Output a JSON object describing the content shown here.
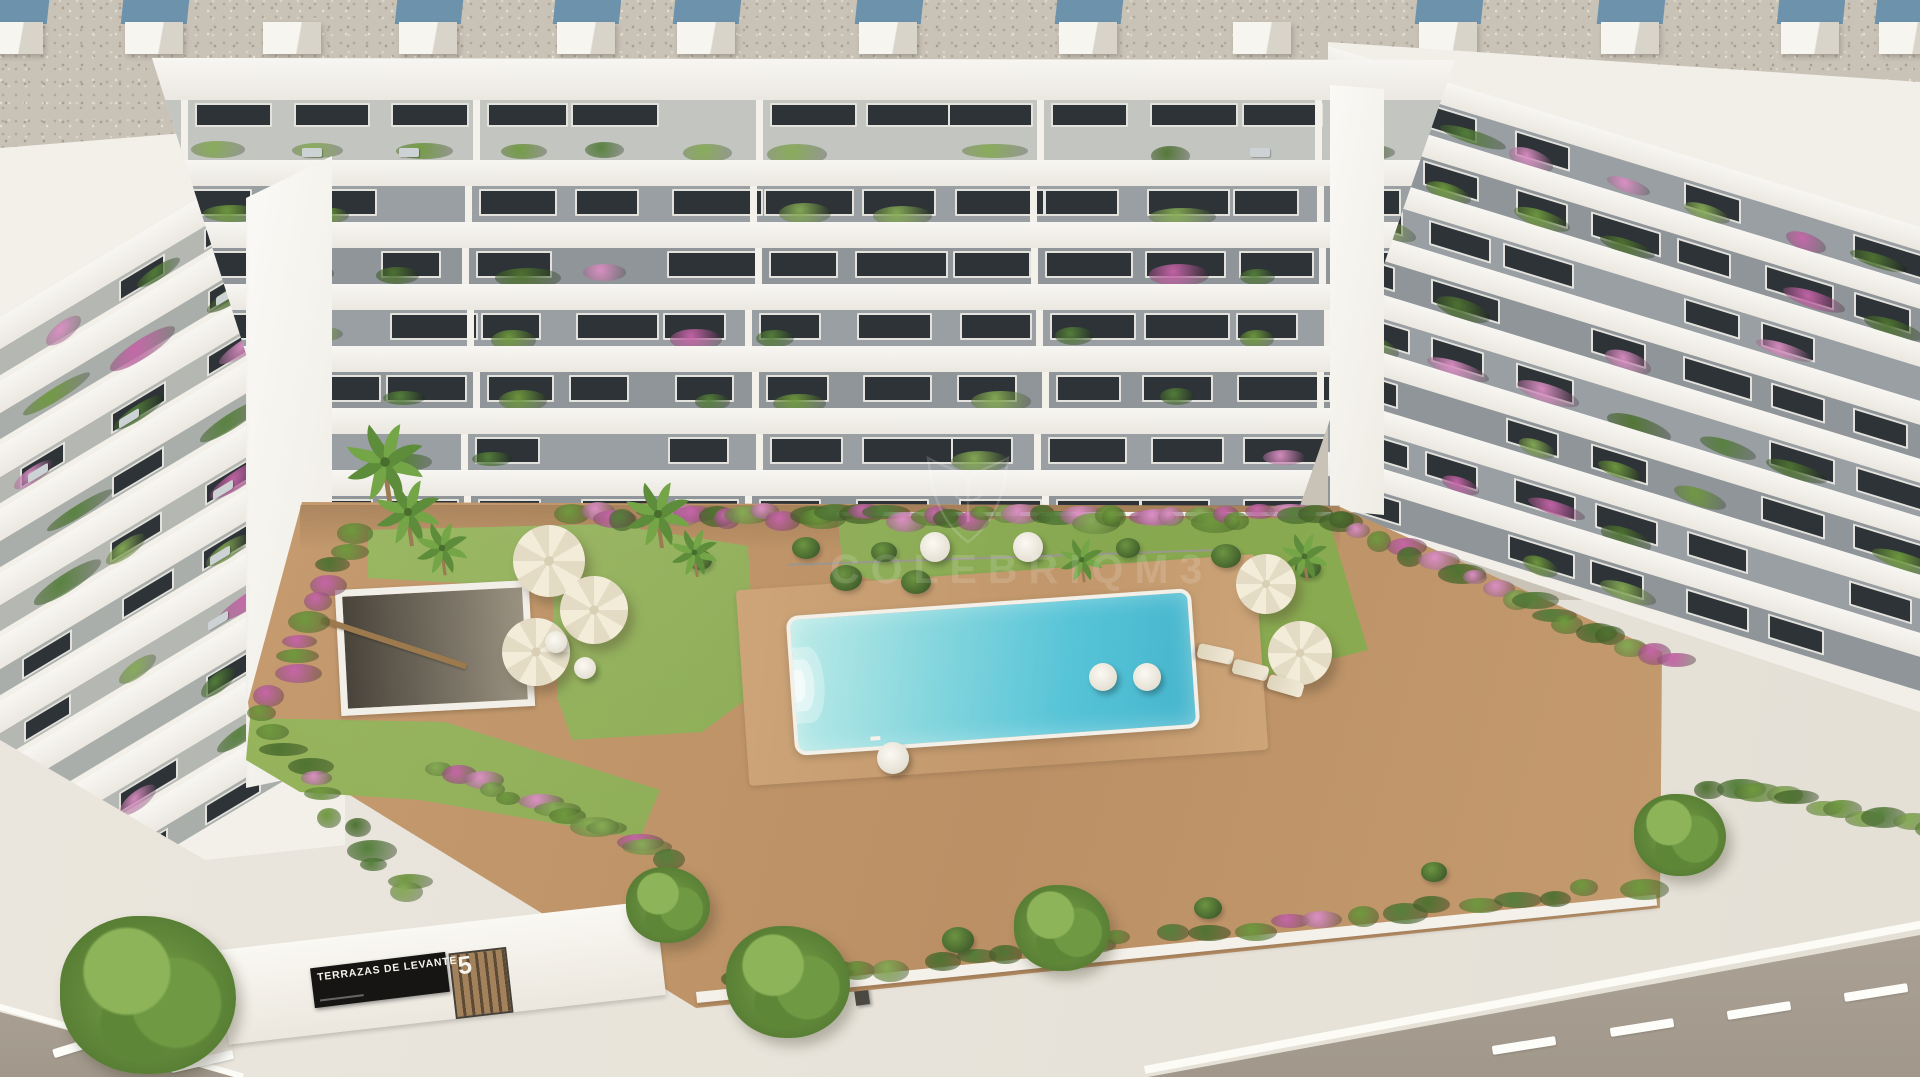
{
  "image_type": "3d-aerial-render",
  "subject": "white residential apartment complex with communal pool, lawns and gardens",
  "sign": {
    "title": "TERRAZAS DE LEVANTE",
    "block_number": "5"
  },
  "watermark": {
    "emblem": "crest-outline-icon",
    "text": "COLEBRIQM3",
    "opacity": 0.14
  },
  "palette": {
    "gravel": "#c9c2b6",
    "vent_blue": "#6d92ac",
    "building_white": "#f5f3ee",
    "facade_gray_a": "#999fa2",
    "facade_gray_b": "#8f9598",
    "penthouse_gray": "#c3c5c0",
    "left_terrace_gray": "#b4b7b2",
    "window_dark": "#2d3337",
    "path_tan": "#c49a6c",
    "lawn_green": "#8fae52",
    "pool_light": "#bdebe8",
    "pool_deep": "#45b5cd",
    "road": "#a69d90",
    "sidewalk": "#e8e4db",
    "flower_pink": "#c765a9",
    "flower_pink_light": "#dc8fc4",
    "foliage": [
      "#6f9a3e",
      "#55803a",
      "#86ab55",
      "#4f7431"
    ],
    "wood": "#9c7a4e",
    "sign_black": "#161513"
  },
  "scene": {
    "roof_vents": {
      "xs": [
        -18,
        122,
        260,
        396,
        554,
        674,
        856,
        1056,
        1230,
        1416,
        1598,
        1778,
        1876
      ],
      "white_only_idx": [
        2,
        8
      ]
    },
    "building": {
      "central_floors": 7,
      "left_wing_rows": 10,
      "right_wing_rows": 8
    },
    "pool": {
      "x": 790,
      "y": 602,
      "w": 398,
      "h": 132,
      "rotate_deg": -4,
      "steps": "left-end"
    },
    "objects": {
      "palms": [
        [
          385,
          462,
          1.2
        ],
        [
          408,
          512,
          1.0
        ],
        [
          442,
          548,
          0.8
        ],
        [
          658,
          514,
          1.0
        ],
        [
          694,
          552,
          0.72
        ],
        [
          1082,
          560,
          0.66
        ],
        [
          1304,
          556,
          0.72
        ]
      ],
      "trees": [
        [
          148,
          995,
          88
        ],
        [
          788,
          982,
          62
        ],
        [
          1062,
          928,
          48
        ],
        [
          1680,
          835,
          46
        ],
        [
          668,
          905,
          42
        ]
      ],
      "umbrellas": [
        [
          549,
          561,
          36
        ],
        [
          594,
          610,
          34
        ],
        [
          536,
          652,
          34
        ],
        [
          1266,
          584,
          30
        ],
        [
          1300,
          653,
          32
        ]
      ],
      "day_beds": [
        [
          935,
          547,
          15
        ],
        [
          1028,
          547,
          15
        ],
        [
          1103,
          677,
          14
        ],
        [
          1147,
          677,
          14
        ],
        [
          893,
          758,
          16
        ],
        [
          556,
          642,
          11
        ],
        [
          585,
          668,
          11
        ]
      ],
      "sun_loungers": [
        [
          1208,
          636,
          102
        ],
        [
          1243,
          652,
          104
        ],
        [
          1278,
          668,
          106
        ]
      ],
      "bushes": [
        [
          806,
          548,
          14
        ],
        [
          846,
          578,
          16
        ],
        [
          884,
          552,
          13
        ],
        [
          916,
          582,
          15
        ],
        [
          1128,
          548,
          12
        ],
        [
          1226,
          556,
          15
        ],
        [
          1266,
          590,
          17
        ],
        [
          1308,
          568,
          13
        ],
        [
          958,
          940,
          16
        ],
        [
          1208,
          908,
          14
        ],
        [
          1434,
          872,
          13
        ],
        [
          700,
          560,
          12
        ]
      ],
      "hedges": [
        [
          560,
          507,
          1332,
          509,
          46,
          0.45
        ],
        [
          336,
          527,
          252,
          700,
          11,
          0.4
        ],
        [
          1344,
          524,
          1652,
          652,
          17,
          0.35
        ],
        [
          252,
          722,
          396,
          886,
          11,
          0.3
        ],
        [
          418,
          758,
          648,
          846,
          13,
          0.35
        ],
        [
          1694,
          776,
          1912,
          820,
          11,
          0.15
        ],
        [
          724,
          972,
          1614,
          878,
          24,
          0.12
        ]
      ],
      "lane_dashes": [
        [
          52,
          1040,
          -17
        ],
        [
          170,
          1057,
          -13
        ],
        [
          1492,
          1041,
          -9
        ],
        [
          1610,
          1023,
          -9
        ],
        [
          1727,
          1006,
          -9
        ],
        [
          1844,
          988,
          -9
        ]
      ]
    }
  }
}
